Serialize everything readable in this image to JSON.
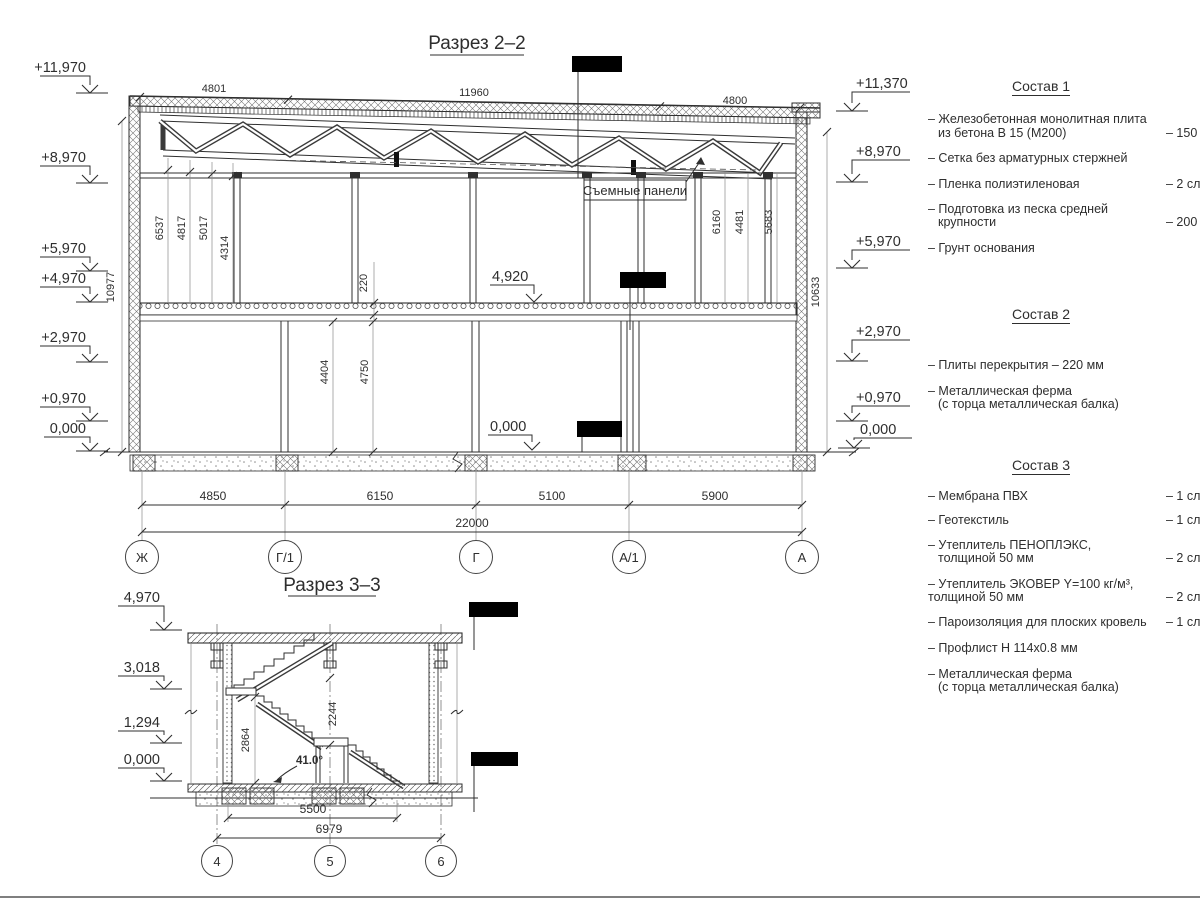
{
  "section2": {
    "title": "Разрез 2–2",
    "elevL": [
      "+11,970",
      "+8,970",
      "+5,970",
      "+4,970",
      "+2,970",
      "+0,970",
      "0,000"
    ],
    "elevR": [
      "+11,370",
      "+8,970",
      "+5,970",
      "+2,970",
      "+0,970",
      "0,000"
    ],
    "top_dims": [
      "4801",
      "11960",
      "4800"
    ],
    "vleft": [
      "6537",
      "4817",
      "5017",
      "4314"
    ],
    "vright": [
      "6160",
      "4481",
      "5683"
    ],
    "hleft": "10977",
    "hright": "10633",
    "slab": "220",
    "vlow": [
      "4404",
      "4750"
    ],
    "floor_mark": "4,920",
    "ground_mark": "0,000",
    "panel_label": "Съемные панели",
    "bdims": [
      "4850",
      "6150",
      "5100",
      "5900"
    ],
    "total": "22000",
    "axes": [
      "Ж",
      "Г/1",
      "Г",
      "А/1",
      "А"
    ]
  },
  "section3": {
    "title": "Разрез 3–3",
    "elevL": [
      "4,970",
      "3,018",
      "1,294",
      "0,000"
    ],
    "d2864": "2864",
    "d2244": "2244",
    "angle": "41.0°",
    "bdims": [
      "5500",
      "6979"
    ],
    "axes": [
      "4",
      "5",
      "6"
    ]
  },
  "notes": {
    "s1": {
      "title": "Состав 1",
      "items": [
        {
          "l1": "– Железобетонная  монолитная плита",
          "l2": "из бетона В 15 (М200)",
          "v": "– 150 мм"
        },
        {
          "l1": "– Сетка без арматурных стержней",
          "l2": "",
          "v": ""
        },
        {
          "l1": "– Пленка полиэтиленовая",
          "l2": "",
          "v": "– 2 слоя"
        },
        {
          "l1": "– Подготовка из песка средней",
          "l2": "крупности",
          "v": "– 200 мм"
        },
        {
          "l1": "– Грунт основания",
          "l2": "",
          "v": ""
        }
      ]
    },
    "s2": {
      "title": "Состав 2",
      "items": [
        {
          "l1": "– Плиты перекрытия – 220 мм",
          "l2": "",
          "v": ""
        },
        {
          "l1": "– Металлическая ферма",
          "l2": "(с торца металлическая балка)",
          "v": ""
        }
      ]
    },
    "s3": {
      "title": "Состав 3",
      "items": [
        {
          "l1": "– Мембрана ПВХ",
          "l2": "",
          "v": "– 1 слой"
        },
        {
          "l1": "– Геотекстиль",
          "l2": "",
          "v": "– 1 слой"
        },
        {
          "l1": "– Утеплитель ПЕНОПЛЭКС,",
          "l2": "толщиной 50 мм",
          "v": "– 2 слоя"
        },
        {
          "l1": "– Утеплитель ЭКОВЕР Y=100 кг/м³,",
          "l2": "толщиной 50 мм",
          "v": "– 2 слоя"
        },
        {
          "l1": "– Пароизоляция для плоских кровель",
          "l2": "",
          "v": "– 1 слой"
        },
        {
          "l1": "– Профлист Н 114х0.8 мм",
          "l2": "",
          "v": ""
        },
        {
          "l1": "– Металлическая ферма",
          "l2": "(с торца металлическая балка)",
          "v": ""
        }
      ]
    }
  }
}
